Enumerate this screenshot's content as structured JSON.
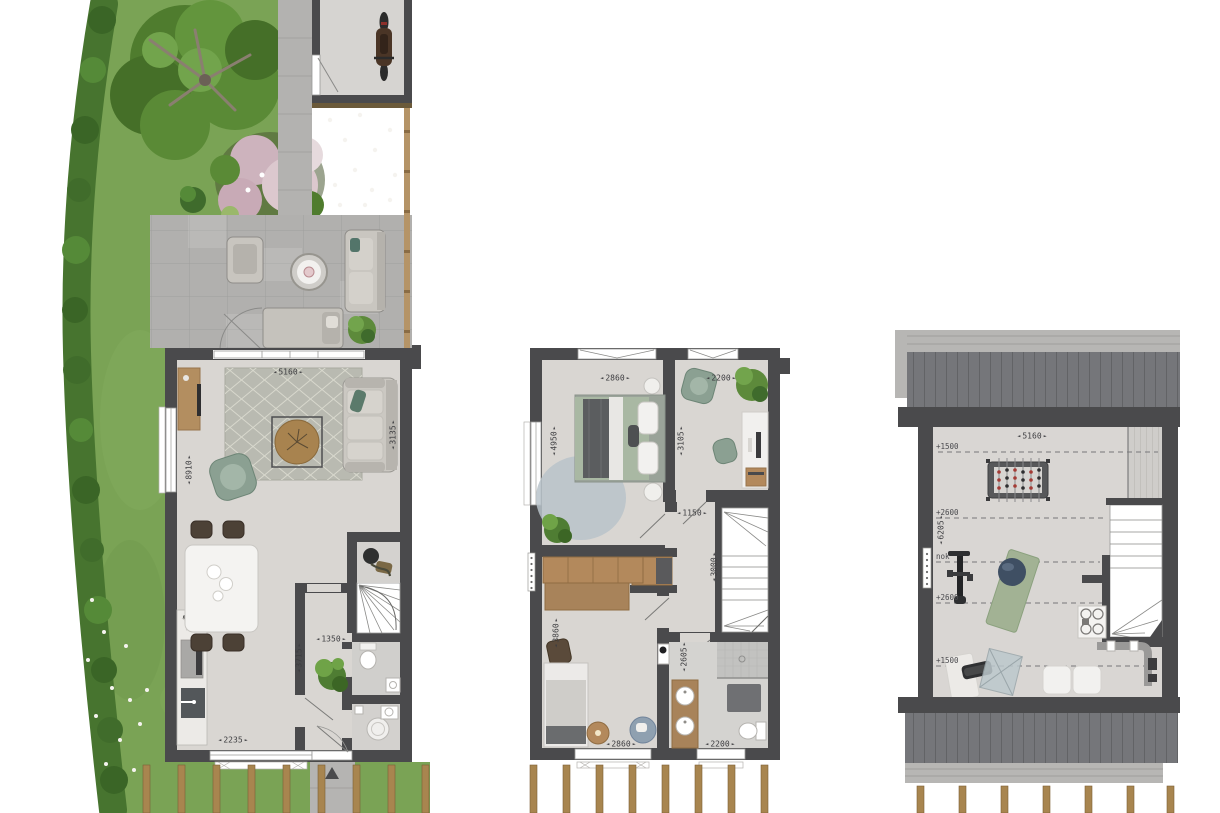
{
  "colors": {
    "wall": "#4a4a4c",
    "floor": "#d9d6d2",
    "terrace": "#b1b0ae",
    "grass": "#7aa355",
    "hedge": "#47742f",
    "wood_furniture": "#b3895c",
    "roof_planks": "#75767a",
    "pergola_post": "#a8854f",
    "sage_furniture": "#8ba092",
    "dim_text": "#3d3d40"
  },
  "ground_floor": {
    "dims": {
      "living_width": "5160",
      "depth": "8910",
      "living_length_right": "3135",
      "hall_width": "1350",
      "hall_depth": "3715",
      "kitchen_window_width": "2235"
    }
  },
  "first_floor": {
    "dims": {
      "bedroom1_width": "2860",
      "study_width": "2200",
      "bedroom1_depth": "4950",
      "study_depth": "3105",
      "landing_width": "1150",
      "stairs_depth": "3000",
      "bedroom2_depth": "3860",
      "bathroom_depth": "2605",
      "bedroom2_width": "2860",
      "bathroom_width": "2200"
    }
  },
  "attic": {
    "dims": {
      "width": "5160",
      "depth": "6205"
    },
    "height_lines": [
      {
        "label": "+1500"
      },
      {
        "label": "+2600"
      },
      {
        "label": "nok"
      },
      {
        "label": "+2600"
      },
      {
        "label": "+1500"
      }
    ]
  }
}
